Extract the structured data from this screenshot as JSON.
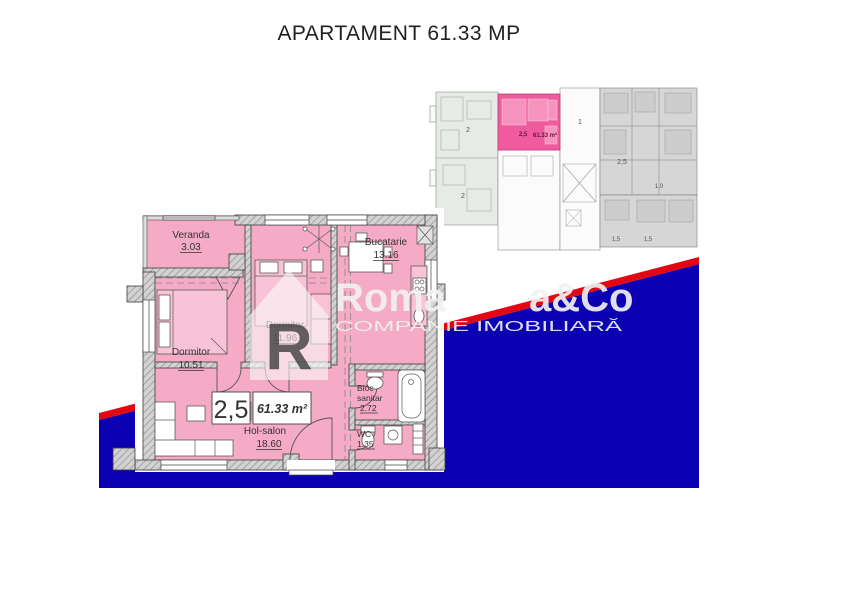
{
  "page": {
    "title": "APARTAMENT 61.33 MP"
  },
  "colors": {
    "accent_blue": "#0b00b2",
    "accent_red": "#e30613",
    "plan_pink": "#f5aac6",
    "highlight_pink": "#ee5c9e"
  },
  "floor_plan": {
    "type_label": "2,5",
    "total_area": "61.33 m²",
    "rooms": [
      {
        "name": "Veranda",
        "area": "3.03"
      },
      {
        "name": "Bucatarie",
        "area": "13.16"
      },
      {
        "name": "Dormitor",
        "area": "11.96"
      },
      {
        "name": "Dormitor",
        "area": "10.51"
      },
      {
        "name": "Hol-salon",
        "area": "18.60"
      },
      {
        "name": "Bloc sanitar",
        "name_line1": "Bloc",
        "name_line2": "sanitar",
        "area": "2.72"
      },
      {
        "name": "WC",
        "area": "1.35"
      }
    ]
  },
  "site_plan": {
    "units": [
      {
        "label": "2"
      },
      {
        "label": "2"
      },
      {
        "label": "1"
      },
      {
        "label": "2,5"
      },
      {
        "label": "1,0"
      },
      {
        "label": "1,5"
      },
      {
        "label": "1,5"
      }
    ],
    "highlight": {
      "type_label": "2,5",
      "area_label": "61.33 m²"
    }
  },
  "watermark": {
    "logo_letter": "R",
    "brand_left": "Roma",
    "brand_right": "a&Co",
    "tagline": "COMPANIE IMOBILIARĂ"
  }
}
